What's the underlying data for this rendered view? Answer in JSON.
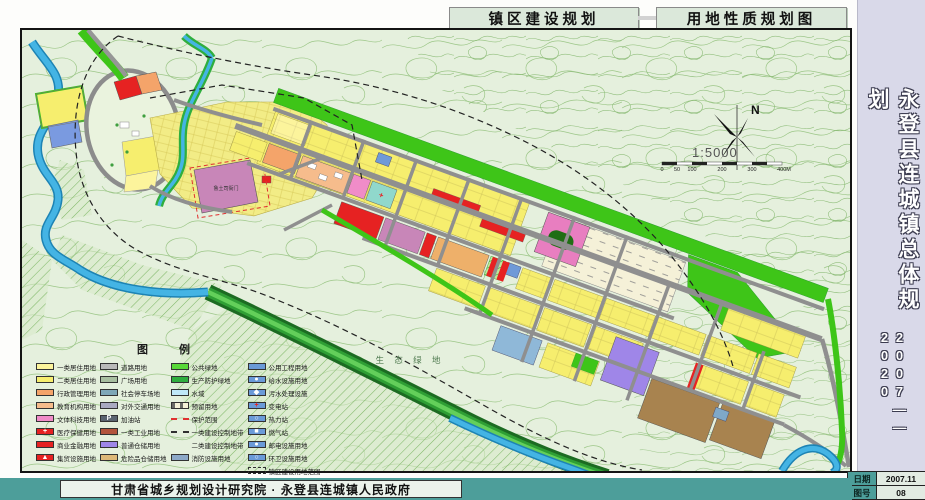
{
  "header": {
    "title1": "镇区建设规划",
    "title2": "用地性质规划图"
  },
  "sidebar": {
    "title": "永登县连城镇总体规划",
    "years": "2007——2020",
    "date_label": "日期",
    "date_value": "2007.11",
    "figure_label": "图号",
    "figure_value": "08"
  },
  "footer": {
    "credit": "甘肃省城乡规划设计研究院 · 永登县连城镇人民政府"
  },
  "map": {
    "labels": {
      "lu_yamen": "鲁土司衙门",
      "eco_green": "生 态 绿 地",
      "north": "N",
      "scale_ratio": "1:5000"
    },
    "scale_ticks": [
      "0",
      "50",
      "100",
      "200",
      "300",
      "400M"
    ]
  },
  "colors": {
    "teal_bar": "#4d9e9a",
    "sidebar_bg": "#d9d9e9",
    "header_box_bg": "#dbe8da",
    "map_bg": "#e5f0dd",
    "water": "#44b4e4",
    "road": "#969696",
    "protective_green": "#3ec518"
  },
  "legend": {
    "title": "图  例",
    "columns": [
      [
        {
          "label": "一类居住用地",
          "color": "#fcf49c",
          "icon": "swatch-residential-1"
        },
        {
          "label": "二类居住用地",
          "color": "#f6ee6e",
          "icon": "swatch-residential-2"
        },
        {
          "label": "行政管理用地",
          "color": "#f4a46a",
          "icon": "swatch-administration"
        },
        {
          "label": "教育机构用地",
          "color": "#f6bc8c",
          "icon": "swatch-education"
        },
        {
          "label": "文体科技用地",
          "color": "#f08cc8",
          "icon": "swatch-culture-sports"
        },
        {
          "label": "医疗保健用地",
          "color": "#e62222",
          "mark": "+",
          "icon": "swatch-medical"
        },
        {
          "label": "商业金融用地",
          "color": "#e62222",
          "icon": "swatch-commercial"
        },
        {
          "label": "集贸设施用地",
          "color": "#e62222",
          "mark": "▲",
          "icon": "swatch-market"
        }
      ],
      [
        {
          "label": "道路用地",
          "color": "#b9b9b9",
          "icon": "swatch-road"
        },
        {
          "label": "广场用地",
          "color": "#a8bfa0",
          "icon": "swatch-square"
        },
        {
          "label": "社会停车场地",
          "color": "#7fa8b8",
          "icon": "swatch-parking"
        },
        {
          "label": "对外交通用地",
          "color": "#a9a9c0",
          "icon": "swatch-external-transport"
        },
        {
          "label": "加油站",
          "color": "#5a6470",
          "mark": "P",
          "icon": "swatch-gas-station"
        },
        {
          "label": "一类工业用地",
          "color": "#b2543c",
          "icon": "swatch-industry-1"
        },
        {
          "label": "普通仓储用地",
          "color": "#9f86e8",
          "icon": "swatch-warehouse"
        },
        {
          "label": "危险品仓储用地",
          "color": "#deb878",
          "icon": "swatch-hazard-warehouse"
        }
      ],
      [
        {
          "label": "公共绿地",
          "color": "#58d838",
          "icon": "swatch-public-green"
        },
        {
          "label": "生产防护绿地",
          "color": "#2fae3e",
          "icon": "swatch-protective-green"
        },
        {
          "label": "水域",
          "color": "#bfe8f8",
          "icon": "swatch-water"
        },
        {
          "label": "预留用地",
          "color": "#f5f1d8",
          "kind": "rect-dash",
          "icon": "swatch-reserved-land"
        },
        {
          "label": "保护范围",
          "kind": "line",
          "style": "dashed",
          "color": "#e03030",
          "icon": "line-protection-boundary"
        },
        {
          "label": "一类建设控制地带",
          "kind": "line",
          "style": "dashed",
          "color": "#303030",
          "icon": "line-control-zone-1"
        },
        {
          "label": "二类建设控制地带",
          "kind": "line",
          "style": "dashdot",
          "color": "#3060c0",
          "icon": "line-control-zone-2"
        },
        {
          "label": "消防设施用地",
          "color": "#8ca8c8",
          "icon": "swatch-fire-facility"
        }
      ],
      [
        {
          "label": "公用工程用地",
          "color": "#6a9ad8",
          "icon": "swatch-utility"
        },
        {
          "label": "给水设施用地",
          "color": "#6a9ad8",
          "mark": "●",
          "icon": "swatch-water-supply"
        },
        {
          "label": "污水处理设施",
          "color": "#6a9ad8",
          "mark": "◆",
          "icon": "swatch-sewage"
        },
        {
          "label": "变电站",
          "color": "#6a9ad8",
          "mark": "+",
          "markColor": "#e62222",
          "icon": "swatch-substation"
        },
        {
          "label": "热力站",
          "color": "#6a9ad8",
          "mark": "○",
          "icon": "swatch-heating"
        },
        {
          "label": "燃气站",
          "color": "#6a9ad8",
          "mark": "■",
          "icon": "swatch-gas"
        },
        {
          "label": "邮电设施用地",
          "color": "#6a9ad8",
          "mark": "●",
          "icon": "swatch-post-telecom"
        },
        {
          "label": "环卫设施用地",
          "color": "#6a9ad8",
          "mark": "○",
          "icon": "swatch-sanitation"
        },
        {
          "label": "镇区建设用地范围",
          "kind": "rect-outline-dash",
          "color": "#303030",
          "icon": "line-town-boundary"
        }
      ]
    ]
  }
}
